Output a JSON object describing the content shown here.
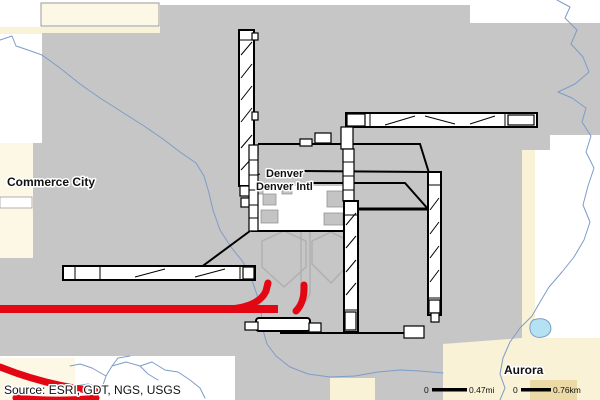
{
  "map": {
    "labels": {
      "commerce_city": "Commerce City",
      "denver": "Denver",
      "denver_intl": "Denver Intl",
      "aurora": "Aurora"
    },
    "source_note": "Source: ESRI, GDT, NGS, USGS",
    "scale": {
      "mi_zero": "0",
      "mi_value": "0.47mi",
      "km_zero": "0",
      "km_value": "0.76km"
    },
    "colors": {
      "airport_gray": "#c6c6c6",
      "parcel_cream": "#f9f2d6",
      "parcel_cream_light": "#fdf8e6",
      "parcel_tan": "#ecdaa6",
      "water_blue": "#7d9cc8",
      "pond_blue": "#b5e2f2",
      "track_red": "#e30613",
      "runway_white": "#ffffff",
      "outline_black": "#000000",
      "concourse_gray": "#b0b0b0"
    }
  }
}
